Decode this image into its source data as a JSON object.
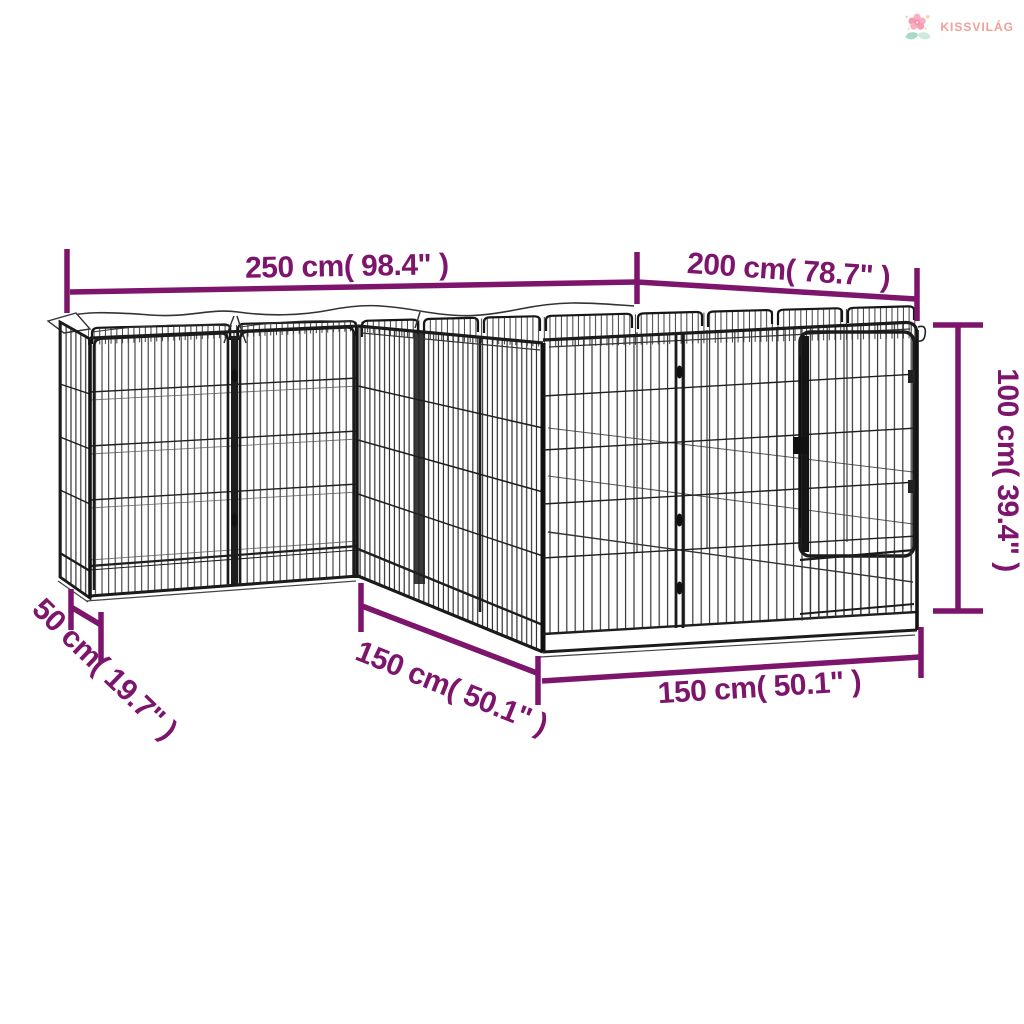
{
  "brand": {
    "name": "KISSVILÁG",
    "icon": "flower-icon",
    "text_color": "#F0A097"
  },
  "drawing": {
    "subject": "dog playpen wireframe line drawing with dimension annotations"
  },
  "colors": {
    "dimension_accent": "#7D156C",
    "line_art": "#1b1b1b",
    "background": "#FFFFFF"
  },
  "dimensions": {
    "top_left": {
      "label": "250 cm( 98.4\" )"
    },
    "top_right": {
      "label": "200 cm( 78.7\" )"
    },
    "height_right": {
      "label": "100 cm( 39.4\" )"
    },
    "bottom_left": {
      "label": "50 cm( 19.7\" )"
    },
    "bottom_diagonal": {
      "label": "150 cm( 50.1\" )"
    },
    "bottom_front": {
      "label": "150 cm( 50.1\" )"
    }
  }
}
